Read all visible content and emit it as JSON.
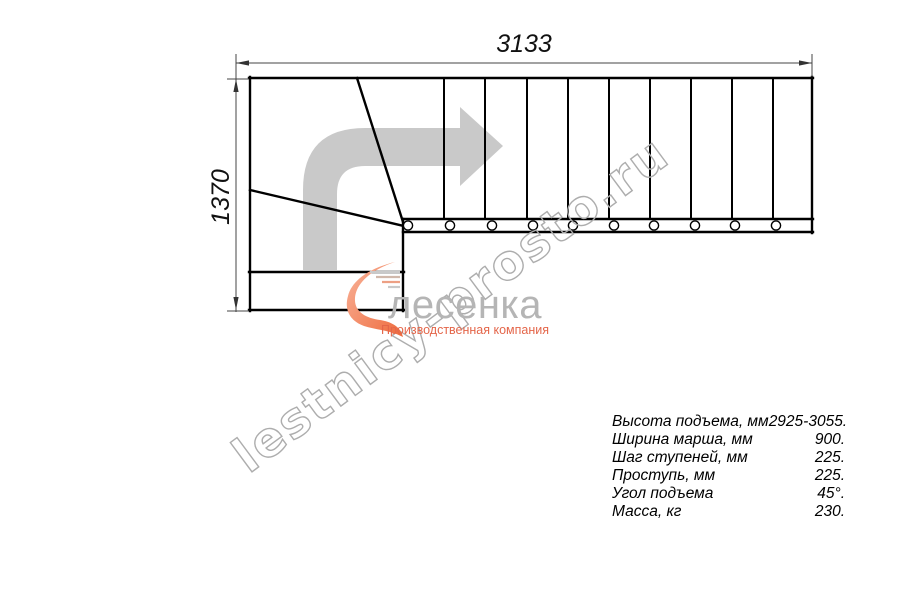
{
  "drawing": {
    "title_hint": "staircase-plan-top-view",
    "width_dimension": "3133",
    "height_dimension": "1370",
    "direction_arrow_icon": "turn-right-arrow-icon",
    "baluster_count": 10,
    "colors": {
      "plan_line": "#000000",
      "dimension_line": "#444444",
      "arrow_fill": "#c9c9c9",
      "watermark_stroke": "#adadad"
    }
  },
  "watermark": {
    "text": "lestnicy-prosto.ru"
  },
  "logo": {
    "icon": "flame-swoosh-icon",
    "name": "лесенка",
    "tagline": "Производственная компания",
    "name_color": "#b5b5b5",
    "tagline_color": "#e4664a",
    "icon_color": "#ee6a3c"
  },
  "specs": {
    "rows": [
      {
        "label": "Высота подъема, мм",
        "value": "2925-3055."
      },
      {
        "label": "Ширина марша, мм",
        "value": "900."
      },
      {
        "label": "Шаг ступеней, мм",
        "value": "225."
      },
      {
        "label": "Проступь, мм",
        "value": "225."
      },
      {
        "label": "Угол подъема",
        "value": "45°."
      },
      {
        "label": "Масса, кг",
        "value": "230."
      }
    ]
  }
}
